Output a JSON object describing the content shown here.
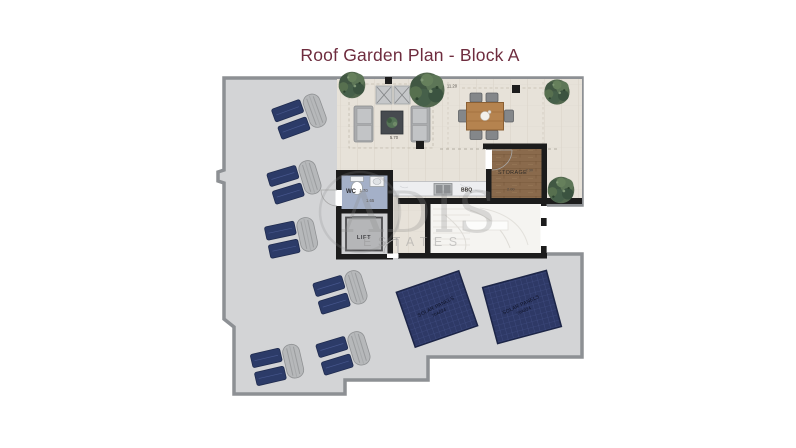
{
  "title": "Roof Garden Plan - Block A",
  "watermark": {
    "brand": "ADIS",
    "subtitle": "ESTATES"
  },
  "plan": {
    "rooms": {
      "wc": {
        "label": "WC",
        "dim1": "1.70",
        "dim2": "1.65"
      },
      "lift": {
        "label": "LIFT"
      },
      "storage": {
        "label": "STORAGE",
        "dim1": "2.30",
        "dim2": "2.00"
      },
      "bbq": {
        "label": "BBQ"
      }
    },
    "dimensions": {
      "top": "11.20",
      "lounge": "5.70"
    },
    "solar": {
      "line1": "SOLAR PANELS",
      "line2": "70A024"
    },
    "features": {
      "sun_lounger_pairs": 6,
      "solar_panels": 2,
      "trees": 4
    }
  },
  "colors": {
    "title_text": "#6e2c3e",
    "terrace": "#d3d4d6",
    "terrace_border": "#8d9094",
    "patio_tile": "#e7e2d9",
    "wall": "#1c1c1c",
    "wc_floor": "#a4b0c8",
    "storage_wood": "#8a6a4c",
    "lounger_navy": "#2c3b68",
    "solar_navy": "#2e3966",
    "tree_green": "#52684e",
    "table_wood": "#b5834f"
  }
}
